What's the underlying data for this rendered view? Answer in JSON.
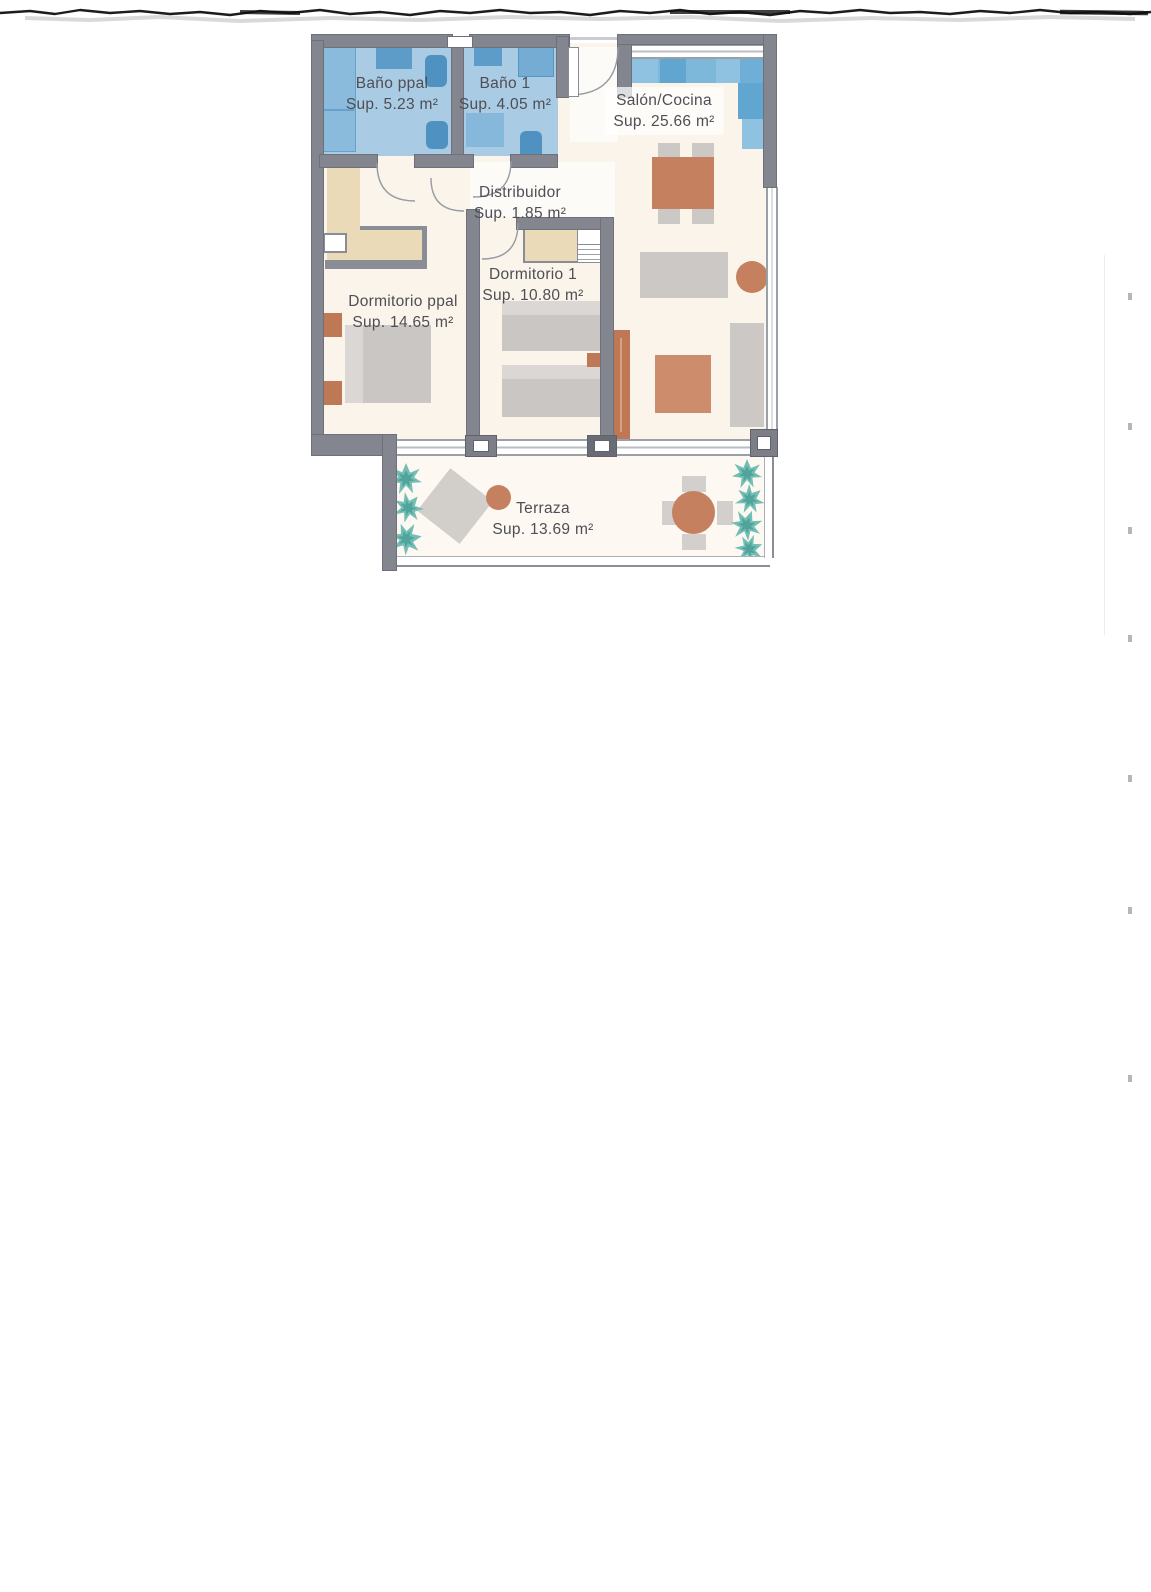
{
  "artifact": {
    "type": "scanned apartment floor plan"
  },
  "palette": {
    "wall": "#84878F",
    "bath_floor": "#A9CBE3",
    "bath_fixture": "#5795C4",
    "kitchen_counter": "#7DB8DA",
    "closet": "#EADAB8",
    "furniture_gray": "#C9C6C3",
    "terracotta": "#C5805F",
    "plant": "#74BEB6",
    "floor": "#FBF4EA",
    "label_text": "#4E4E54"
  },
  "plan": {
    "rooms": [
      {
        "id": "bano-ppal",
        "name": "Baño ppal",
        "area": "Sup. 5.23 m²"
      },
      {
        "id": "bano-1",
        "name": "Baño 1",
        "area": "Sup. 4.05 m²"
      },
      {
        "id": "salon-cocina",
        "name": "Salón/Cocina",
        "area": "Sup. 25.66 m²"
      },
      {
        "id": "distribuidor",
        "name": "Distribuidor",
        "area": "Sup. 1.85 m²"
      },
      {
        "id": "dormitorio-1",
        "name": "Dormitorio 1",
        "area": "Sup. 10.80 m²"
      },
      {
        "id": "dormitorio-ppal",
        "name": "Dormitorio ppal",
        "area": "Sup. 14.65 m²"
      },
      {
        "id": "terraza",
        "name": "Terraza",
        "area": "Sup. 13.69 m²"
      }
    ]
  }
}
